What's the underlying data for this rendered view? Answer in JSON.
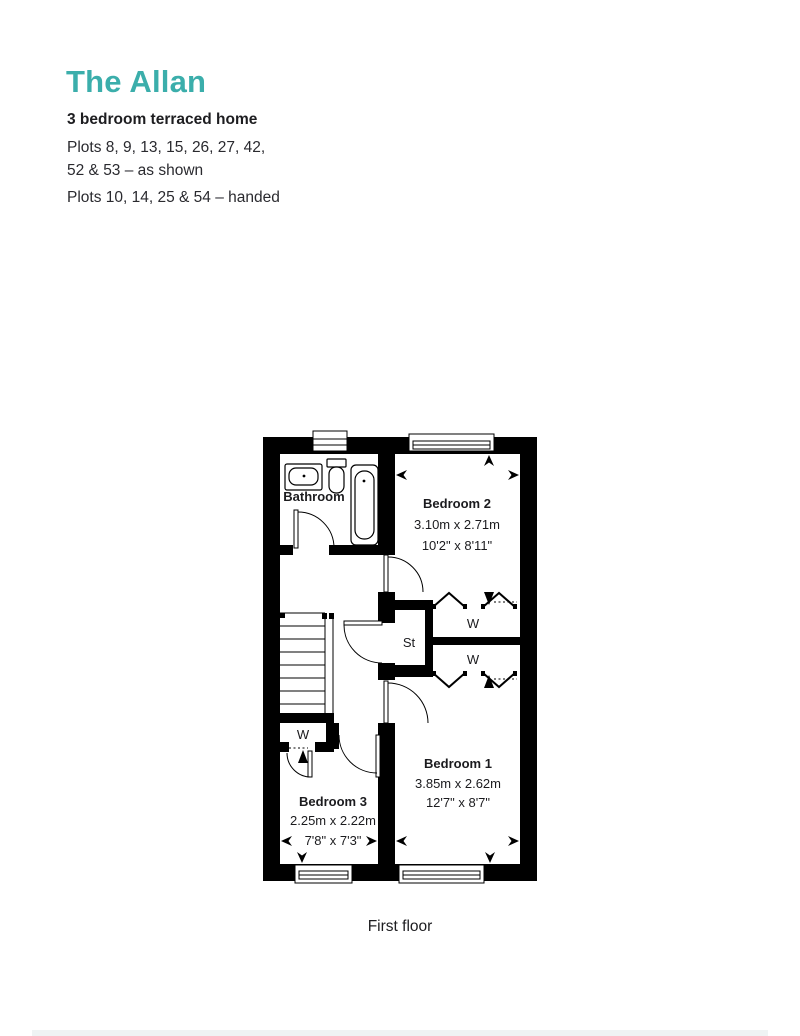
{
  "header": {
    "title": "The Allan",
    "subtitle": "3 bedroom terraced home",
    "plots_shown_line1": "Plots 8, 9, 13, 15, 26, 27, 42,",
    "plots_shown_line2": "52 & 53 – as shown",
    "plots_handed": "Plots 10, 14, 25 & 54 – handed"
  },
  "floorplan": {
    "floor_label": "First floor",
    "rooms": {
      "bathroom": {
        "name": "Bathroom"
      },
      "bedroom2": {
        "name": "Bedroom 2",
        "metric": "3.10m x 2.71m",
        "imperial": "10'2\" x 8'11\""
      },
      "bedroom1": {
        "name": "Bedroom 1",
        "metric": "3.85m x 2.62m",
        "imperial": "12'7\" x 8'7\""
      },
      "bedroom3": {
        "name": "Bedroom 3",
        "metric": "2.25m x 2.22m",
        "imperial": "7'8\" x 7'3\""
      },
      "store": {
        "abbr": "St"
      },
      "wardrobe": {
        "abbr": "W"
      }
    }
  },
  "colors": {
    "accent_teal": "#3BAEAB",
    "wall_black": "#000000",
    "text_dark": "#1d1d20"
  }
}
